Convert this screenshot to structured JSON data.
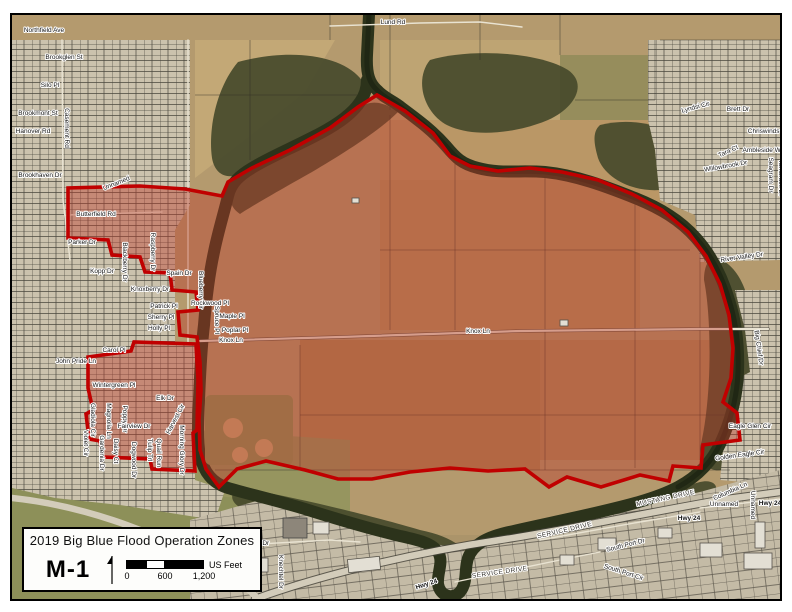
{
  "colors": {
    "flood_fill": "rgba(189,60,42,0.42)",
    "flood_outline": "#c00000",
    "river": "#2c331b",
    "forest": "#474a2b",
    "field_tan": "#b49a6e",
    "urban": "#cbc2ad",
    "grass": "#8e9158"
  },
  "title_box": {
    "title": "2019 Big Blue Flood Operation Zones",
    "zone_label": "M-1",
    "scale": {
      "tick_labels": [
        "0",
        "600",
        "1,200"
      ],
      "units_label": "US Feet"
    }
  },
  "map": {
    "flood_zone_name": "M-1",
    "labels": [
      {
        "t": "Lund Rd",
        "x": 393,
        "y": 24,
        "s": 6.5
      },
      {
        "t": "Northfield Ave",
        "x": 44,
        "y": 32,
        "s": 6
      },
      {
        "t": "Brookglen St",
        "x": 64,
        "y": 59,
        "s": 6
      },
      {
        "t": "Silo Pl",
        "x": 50,
        "y": 87,
        "s": 6
      },
      {
        "t": "Casement Rd",
        "x": 65,
        "y": 128,
        "r": 90,
        "s": 6
      },
      {
        "t": "Brookmont St",
        "x": 38,
        "y": 115,
        "s": 6
      },
      {
        "t": "Hanover Rd",
        "x": 33,
        "y": 133,
        "s": 6
      },
      {
        "t": "Brookhaven Dr",
        "x": 40,
        "y": 177,
        "s": 6
      },
      {
        "t": "Unnamed",
        "x": 117,
        "y": 185,
        "r": -22,
        "s": 6
      },
      {
        "t": "Butterfield Rd",
        "x": 96,
        "y": 216,
        "s": 6.5
      },
      {
        "t": "Parker Dr",
        "x": 82,
        "y": 244,
        "s": 6
      },
      {
        "t": "Kopp Dr",
        "x": 102,
        "y": 273,
        "s": 6
      },
      {
        "t": "Blackberry Dr",
        "x": 123,
        "y": 262,
        "r": 90,
        "s": 6
      },
      {
        "t": "Raspberry Dr",
        "x": 151,
        "y": 252,
        "r": 90,
        "s": 6
      },
      {
        "t": "Knoxberry Dr",
        "x": 150,
        "y": 291,
        "s": 6
      },
      {
        "t": "Spain Dr",
        "x": 179,
        "y": 275,
        "s": 6
      },
      {
        "t": "Blueberry Cir",
        "x": 199,
        "y": 290,
        "r": 90,
        "s": 6
      },
      {
        "t": "Patrick Pl",
        "x": 164,
        "y": 308,
        "s": 6
      },
      {
        "t": "Sherry Pl",
        "x": 161,
        "y": 319,
        "s": 6
      },
      {
        "t": "Holly Pl",
        "x": 159,
        "y": 330,
        "s": 6
      },
      {
        "t": "Rockwood Pl",
        "x": 210,
        "y": 305,
        "s": 6
      },
      {
        "t": "Spruce Pl",
        "x": 215,
        "y": 320,
        "r": 90,
        "s": 6
      },
      {
        "t": "Maple Pl",
        "x": 232,
        "y": 318,
        "s": 6
      },
      {
        "t": "Poplar Pl",
        "x": 235,
        "y": 332,
        "s": 6
      },
      {
        "t": "Knox Ln",
        "x": 231,
        "y": 342,
        "s": 6
      },
      {
        "t": "Knox Ln",
        "x": 478,
        "y": 333,
        "s": 6
      },
      {
        "t": "Carol Pl",
        "x": 114,
        "y": 352,
        "s": 6
      },
      {
        "t": "John Pride Ln",
        "x": 76,
        "y": 363,
        "s": 6
      },
      {
        "t": "Wintergreen Pl",
        "x": 114,
        "y": 387,
        "s": 6
      },
      {
        "t": "Gladiola Cir",
        "x": 91,
        "y": 420,
        "r": 90,
        "s": 6
      },
      {
        "t": "Magnolia Ln",
        "x": 107,
        "y": 421,
        "r": 90,
        "s": 6
      },
      {
        "t": "Poppy Dr",
        "x": 123,
        "y": 419,
        "r": 90,
        "s": 6
      },
      {
        "t": "Elk Dr",
        "x": 165,
        "y": 400,
        "s": 6
      },
      {
        "t": "Fairview Dr",
        "x": 134,
        "y": 428,
        "s": 6
      },
      {
        "t": "Harvest Cir",
        "x": 177,
        "y": 420,
        "r": -62,
        "s": 6
      },
      {
        "t": "Morning Glory Dr",
        "x": 180,
        "y": 450,
        "r": 90,
        "s": 6
      },
      {
        "t": "Tulip Trl",
        "x": 148,
        "y": 450,
        "r": 90,
        "s": 6
      },
      {
        "t": "Dogwood Dr",
        "x": 132,
        "y": 460,
        "r": 90,
        "s": 6
      },
      {
        "t": "Daisy Ct",
        "x": 114,
        "y": 451,
        "r": 90,
        "s": 6
      },
      {
        "t": "Gardenia Dr",
        "x": 100,
        "y": 453,
        "r": 90,
        "s": 6
      },
      {
        "t": "Violet Cir",
        "x": 84,
        "y": 443,
        "r": 90,
        "s": 6
      },
      {
        "t": "Quail Run",
        "x": 157,
        "y": 453,
        "r": 90,
        "s": 6
      },
      {
        "t": "Lyndsi Cir",
        "x": 696,
        "y": 109,
        "r": -15,
        "s": 6
      },
      {
        "t": "Brett Dr",
        "x": 738,
        "y": 111,
        "s": 6
      },
      {
        "t": "Tara Ct",
        "x": 729,
        "y": 153,
        "r": -25,
        "s": 6
      },
      {
        "t": "Chriswinds Dr",
        "x": 768,
        "y": 133,
        "s": 6
      },
      {
        "t": "Ambleside Way",
        "x": 765,
        "y": 152,
        "s": 6
      },
      {
        "t": "Willowbrook Dr",
        "x": 726,
        "y": 168,
        "r": -10,
        "s": 6
      },
      {
        "t": "Seagram Dr",
        "x": 769,
        "y": 175,
        "r": 90,
        "s": 6
      },
      {
        "t": "Tamarack Dr",
        "x": 779,
        "y": 178,
        "r": 90,
        "s": 6
      },
      {
        "t": "River Valley Dr",
        "x": 742,
        "y": 259,
        "r": -8,
        "s": 6
      },
      {
        "t": "Big Chief Dr",
        "x": 757,
        "y": 348,
        "r": 82,
        "s": 6
      },
      {
        "t": "Eagle Glen Cir",
        "x": 750,
        "y": 428,
        "s": 6
      },
      {
        "t": "Golden Eagle Cir",
        "x": 740,
        "y": 457,
        "r": -8,
        "s": 6
      },
      {
        "t": "Levee Dr",
        "x": 256,
        "y": 545,
        "s": 6
      },
      {
        "t": "Knechtel Dr",
        "x": 279,
        "y": 572,
        "r": 90,
        "s": 6
      },
      {
        "t": "MUSTANG DRIVE",
        "x": 666,
        "y": 500,
        "r": -12,
        "s": 6,
        "c": "rd"
      },
      {
        "t": "SERVICE DRIVE",
        "x": 565,
        "y": 532,
        "r": -13,
        "s": 6,
        "c": "rd"
      },
      {
        "t": "SERVICE DRIVE",
        "x": 500,
        "y": 574,
        "r": -8,
        "s": 6,
        "c": "rd"
      },
      {
        "t": "South Port Dr",
        "x": 626,
        "y": 547,
        "r": -14,
        "s": 6
      },
      {
        "t": "South Port Cir",
        "x": 623,
        "y": 574,
        "r": 18,
        "s": 6
      },
      {
        "t": "Columbia Ln",
        "x": 731,
        "y": 493,
        "r": -24,
        "s": 6
      },
      {
        "t": "Unnamed",
        "x": 724,
        "y": 506,
        "s": 6
      },
      {
        "t": "Unnamed",
        "x": 751,
        "y": 505,
        "r": 90,
        "s": 6
      },
      {
        "t": "Hwy 24",
        "x": 689,
        "y": 520,
        "s": 6,
        "c": "hw"
      },
      {
        "t": "Hwy 24",
        "x": 770,
        "y": 505,
        "s": 6,
        "c": "hw"
      },
      {
        "t": "Hwy 24",
        "x": 427,
        "y": 586,
        "r": -18,
        "s": 6,
        "c": "hw"
      }
    ]
  }
}
